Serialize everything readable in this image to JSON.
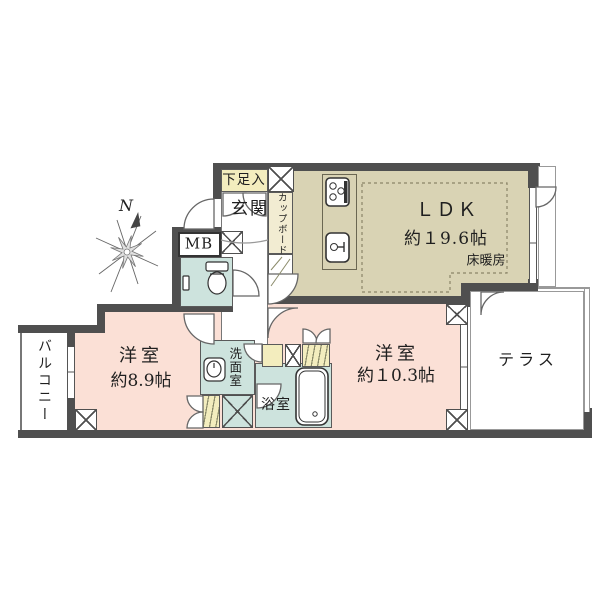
{
  "title": "apartment-floor-plan",
  "compass": {
    "north_label": "N"
  },
  "rooms": {
    "ldk": {
      "name": "ＬＤＫ",
      "size": "約１9.6帖",
      "feature": "床暖房"
    },
    "bedroom1": {
      "name": "洋室",
      "size": "約8.9帖"
    },
    "bedroom2": {
      "name": "洋室",
      "size": "約１0.3帖"
    },
    "terrace": {
      "name": "テラス"
    },
    "balcony": {
      "name": "バルコニー"
    },
    "entrance": {
      "name": "玄関"
    },
    "shoe_box": {
      "name": "下足入"
    },
    "meter_box": {
      "name": "MB"
    },
    "cupboard": {
      "name": "カップボード"
    },
    "washroom": {
      "name": "洗面室"
    },
    "bathroom": {
      "name": "浴室"
    }
  },
  "colors": {
    "wall": "#4f4f4f",
    "ldk_floor": "#d9d3b4",
    "bedroom_floor": "#fbe0d6",
    "wet_area": "#cde3dd",
    "closet_yellow": "#f3edbe",
    "line": "#5a5a5a"
  }
}
